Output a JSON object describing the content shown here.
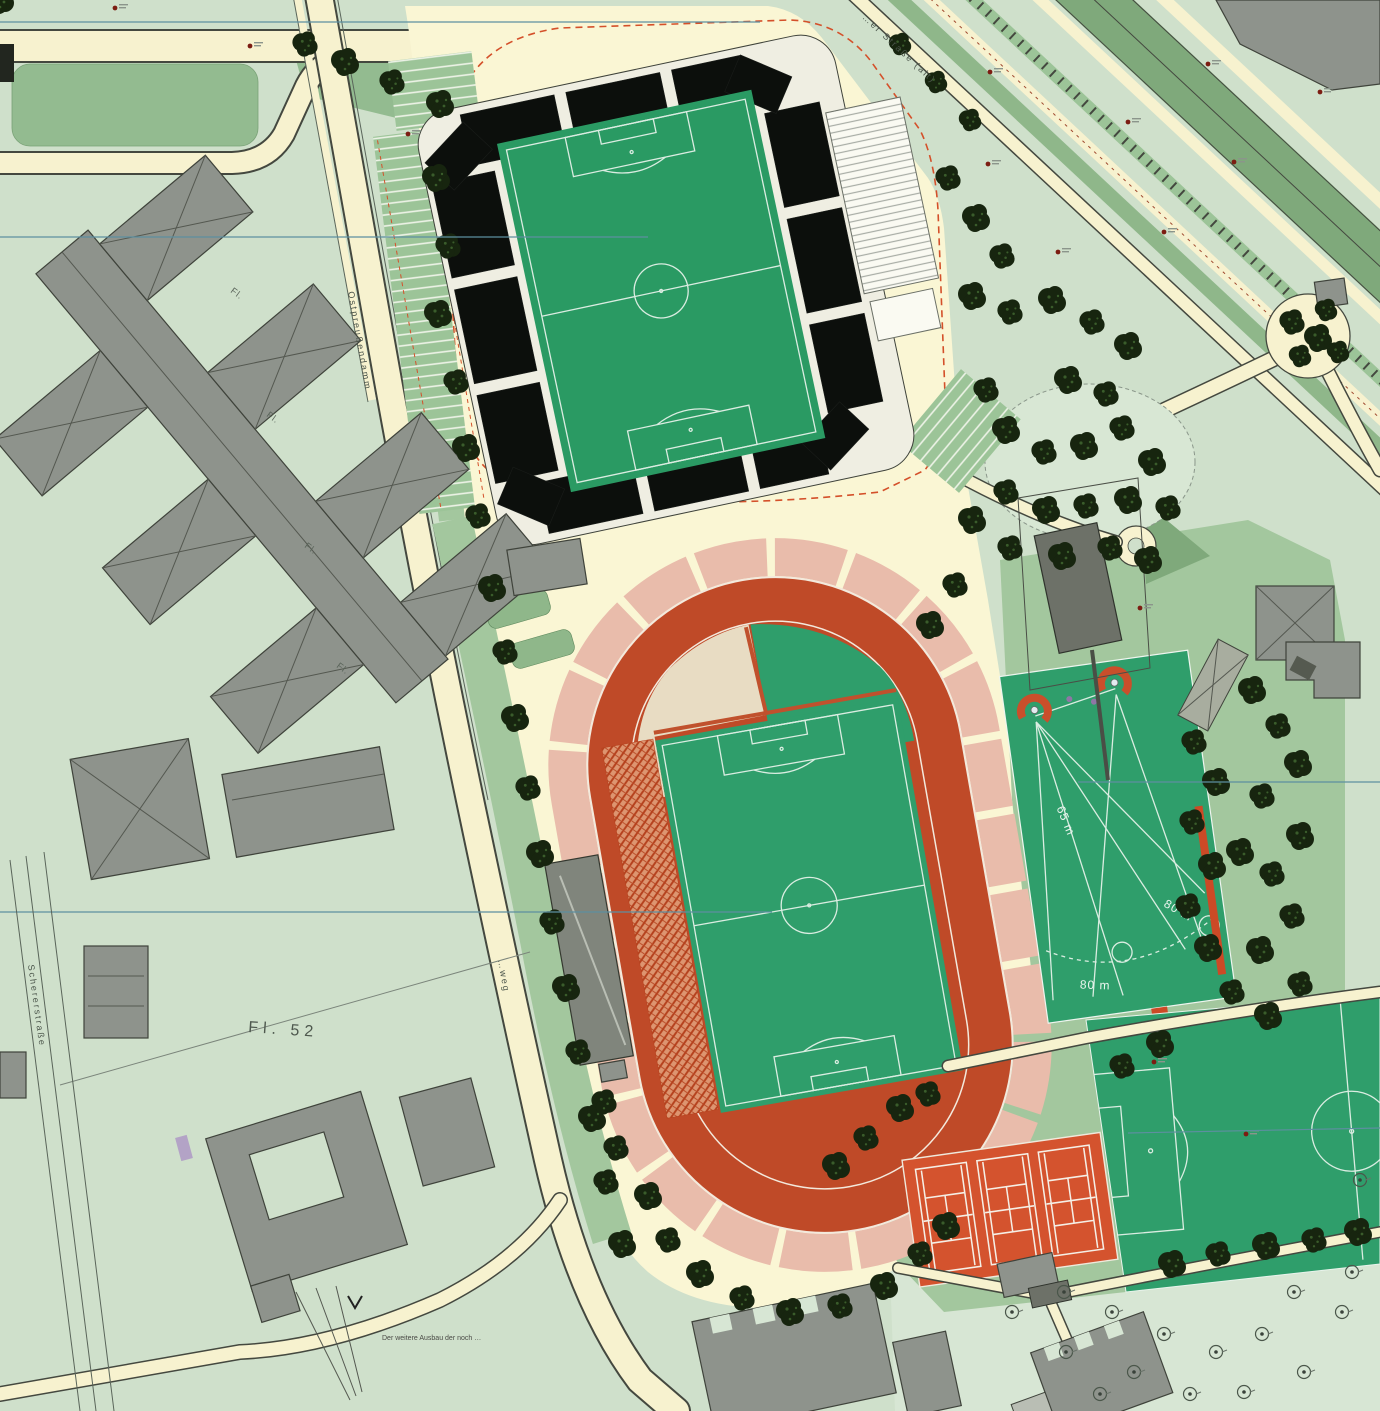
{
  "labels": {
    "parcel": "Fl. 52",
    "fl": "Fl.",
    "throw_65": "65 m",
    "throw_80_a": "80 m",
    "throw_80_b": "80 m",
    "street_left": "Ostpreußendamm",
    "street_sw": "Schererstraße",
    "street_ne": "…er Straße (alt)",
    "path_mid": "…weg",
    "note_sw": "Der weitere Ausbau der noch …"
  },
  "colors": {
    "background": "#cfe0cb",
    "plaza": "#faf6d4",
    "road": "#f7f2cf",
    "pitch_green": "#2f9e6b",
    "track_red": "#bf4a28",
    "track_ring_pink": "#e9bcab",
    "tennis_clay": "#d4532e",
    "tree_dark": "#17250f",
    "building_gray": "#8e938c",
    "median_green": "#7fa97b",
    "accent_dashed_red": "#d4502a",
    "survey_teal": "#5d8fa0"
  }
}
